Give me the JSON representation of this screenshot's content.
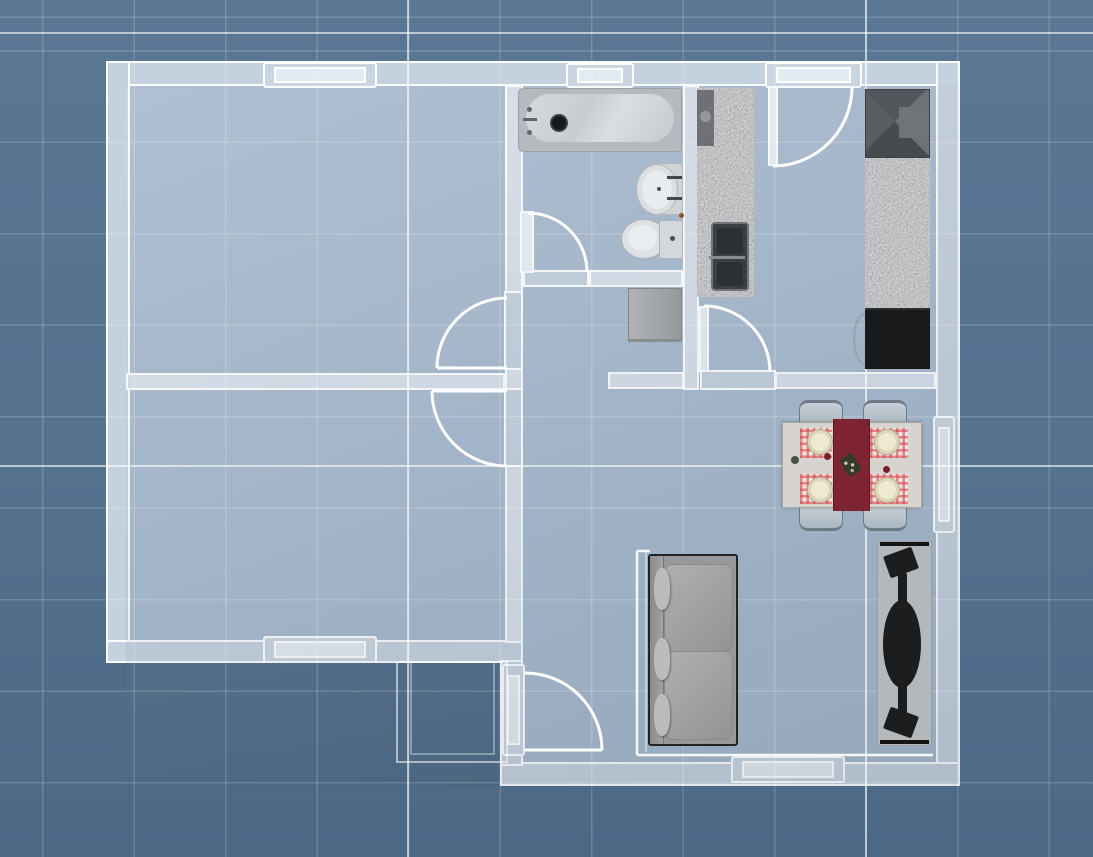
{
  "meta": {
    "view": "2d-floor-plan",
    "style": "blueprint-grid",
    "canvas": {
      "width": 1093,
      "height": 857
    }
  },
  "palette": {
    "background_top": "#5a7794",
    "background_bottom": "#4c6885",
    "grid_minor": "rgba(255,255,255,0.17)",
    "grid_major": "rgba(255,255,255,0.6)",
    "floor": "#a6b9cd",
    "wall_exterior": "#c4d1de",
    "wall_interior": "#d6dfe9",
    "wall_edge": "#ffffff",
    "fixture_light": "#d6dadd",
    "granite": "#898b8e",
    "appliance_dark": "#17191b",
    "runner_red": "#7e2331",
    "placemat_red": "#d8454f",
    "plate_cream": "#efe9d2",
    "chair_gray": "#bcc6cf",
    "sofa_gray": "#98989a",
    "rug_gray": "#b5b8ba"
  },
  "grid": {
    "minor_spacing_px": 91.5,
    "offset_x": 42,
    "offset_y": 50,
    "major_lines": [
      {
        "name": "grid-major-vertical-1",
        "rect": {
          "x": 407,
          "y": 0,
          "w": 2,
          "h": 857
        }
      },
      {
        "name": "grid-major-vertical-2",
        "rect": {
          "x": 865,
          "y": 0,
          "w": 2,
          "h": 857
        }
      },
      {
        "name": "grid-major-horizontal-1",
        "rect": {
          "x": 0,
          "y": 32,
          "w": 1093,
          "h": 2
        }
      },
      {
        "name": "grid-major-horizontal-2",
        "rect": {
          "x": 0,
          "y": 465,
          "w": 1093,
          "h": 2
        }
      }
    ]
  },
  "rooms": [
    {
      "name": "bedroom-1",
      "rect": {
        "x": 126,
        "y": 85,
        "w": 379,
        "h": 288
      }
    },
    {
      "name": "bedroom-2",
      "rect": {
        "x": 126,
        "y": 390,
        "w": 379,
        "h": 253
      }
    },
    {
      "name": "bathroom",
      "rect": {
        "x": 523,
        "y": 85,
        "w": 160,
        "h": 185
      }
    },
    {
      "name": "hallway",
      "rect": {
        "x": 523,
        "y": 270,
        "w": 160,
        "h": 120
      }
    },
    {
      "name": "kitchen",
      "rect": {
        "x": 683,
        "y": 85,
        "w": 253,
        "h": 305
      }
    },
    {
      "name": "living-dining-room",
      "rect": {
        "x": 523,
        "y": 390,
        "w": 413,
        "h": 372
      }
    }
  ],
  "walls": [
    {
      "name": "wall-exterior-top",
      "rect": {
        "x": 106,
        "y": 61,
        "w": 854,
        "h": 25
      }
    },
    {
      "name": "wall-exterior-left",
      "rect": {
        "x": 106,
        "y": 61,
        "w": 24,
        "h": 602
      }
    },
    {
      "name": "wall-bedroom2-south",
      "rect": {
        "x": 106,
        "y": 640,
        "w": 417,
        "h": 23
      }
    },
    {
      "name": "wall-exterior-right",
      "rect": {
        "x": 936,
        "y": 61,
        "w": 24,
        "h": 725
      }
    },
    {
      "name": "wall-living-south",
      "rect": {
        "x": 500,
        "y": 762,
        "w": 460,
        "h": 24
      }
    },
    {
      "name": "wall-living-west",
      "rect": {
        "x": 500,
        "y": 660,
        "w": 23,
        "h": 106
      }
    },
    {
      "name": "wall-center-upper",
      "rect": {
        "x": 505,
        "y": 85,
        "w": 18,
        "h": 208
      }
    },
    {
      "name": "wall-center-lower",
      "rect": {
        "x": 505,
        "y": 465,
        "w": 18,
        "h": 178
      }
    },
    {
      "name": "wall-bedrooms-divider",
      "rect": {
        "x": 126,
        "y": 373,
        "w": 379,
        "h": 17
      }
    },
    {
      "name": "wall-center-junction",
      "rect": {
        "x": 505,
        "y": 368,
        "w": 18,
        "h": 22
      }
    },
    {
      "name": "wall-bathroom-south",
      "rect": {
        "x": 589,
        "y": 270,
        "w": 94,
        "h": 17
      }
    },
    {
      "name": "wall-kitchen-divider",
      "rect": {
        "x": 683,
        "y": 85,
        "w": 16,
        "h": 305
      }
    },
    {
      "name": "wall-hall-south-left",
      "rect": {
        "x": 608,
        "y": 372,
        "w": 76,
        "h": 17
      }
    },
    {
      "name": "wall-hall-south-right",
      "rect": {
        "x": 775,
        "y": 372,
        "w": 161,
        "h": 17
      }
    }
  ],
  "windows": [
    {
      "name": "window-bedroom1-north",
      "orientation": "h",
      "rect": {
        "x": 263,
        "y": 62,
        "w": 114,
        "h": 26
      }
    },
    {
      "name": "window-bathroom-north",
      "orientation": "h",
      "rect": {
        "x": 566,
        "y": 63,
        "w": 68,
        "h": 25
      }
    },
    {
      "name": "window-bedroom2-south",
      "orientation": "h",
      "rect": {
        "x": 263,
        "y": 636,
        "w": 114,
        "h": 27
      }
    },
    {
      "name": "window-living-south",
      "orientation": "h",
      "rect": {
        "x": 731,
        "y": 756,
        "w": 114,
        "h": 27
      }
    },
    {
      "name": "window-dining-east",
      "orientation": "v",
      "rect": {
        "x": 933,
        "y": 416,
        "w": 22,
        "h": 117
      }
    }
  ],
  "doors": [
    {
      "name": "door-bedroom1",
      "frame": {
        "x": 504,
        "y": 291,
        "w": 19,
        "h": 79
      },
      "leaf_line": {
        "x1": 507,
        "y1": 368,
        "x2": 437,
        "y2": 368
      },
      "arc": {
        "x1": 437,
        "y1": 368,
        "x2": 507,
        "y2": 298,
        "r": 70,
        "sweep": 1
      }
    },
    {
      "name": "door-bedroom2",
      "frame": {
        "x": 504,
        "y": 388,
        "w": 19,
        "h": 79
      },
      "leaf_line": {
        "x1": 507,
        "y1": 391,
        "x2": 432,
        "y2": 391
      },
      "arc": {
        "x1": 432,
        "y1": 391,
        "x2": 507,
        "y2": 466,
        "r": 75,
        "sweep": 0
      }
    },
    {
      "name": "door-bathroom",
      "frame": {
        "x": 523,
        "y": 270,
        "w": 66,
        "h": 17
      },
      "leaf_rect": {
        "x": 520,
        "y": 211,
        "w": 14,
        "h": 62
      },
      "arc": {
        "x1": 528,
        "y1": 213,
        "x2": 587,
        "y2": 272,
        "r": 59,
        "sweep": 1
      }
    },
    {
      "name": "door-kitchen-living",
      "frame": {
        "x": 700,
        "y": 370,
        "w": 76,
        "h": 20
      },
      "leaf_rect": {
        "x": 699,
        "y": 306,
        "w": 10,
        "h": 66
      },
      "arc": {
        "x1": 704,
        "y1": 306,
        "x2": 770,
        "y2": 372,
        "r": 66,
        "sweep": 1
      }
    },
    {
      "name": "door-kitchen-north",
      "frame": {
        "x": 765,
        "y": 62,
        "w": 97,
        "h": 26
      },
      "leaf_rect": {
        "x": 768,
        "y": 86,
        "w": 10,
        "h": 80
      },
      "arc": {
        "x1": 773,
        "y1": 166,
        "x2": 852,
        "y2": 87,
        "r": 79,
        "sweep": 0
      }
    },
    {
      "name": "door-entry",
      "frame": {
        "x": 502,
        "y": 664,
        "w": 23,
        "h": 92
      },
      "leaf_line": {
        "x1": 525,
        "y1": 750,
        "x2": 602,
        "y2": 750
      },
      "arc": {
        "x1": 525,
        "y1": 673,
        "x2": 602,
        "y2": 750,
        "r": 77,
        "sweep": 1
      }
    }
  ],
  "furniture": {
    "bathtub": {
      "rect": {
        "x": 518,
        "y": 88,
        "w": 164,
        "h": 64
      }
    },
    "washbasin": {
      "rect": {
        "x": 636,
        "y": 161,
        "w": 47,
        "h": 55
      }
    },
    "toilet": {
      "rect": {
        "x": 621,
        "y": 219,
        "w": 62,
        "h": 40
      }
    },
    "washer": {
      "rect": {
        "x": 628,
        "y": 288,
        "w": 54,
        "h": 54
      }
    },
    "counter_left": {
      "rect": {
        "x": 697,
        "y": 88,
        "w": 57,
        "h": 209
      }
    },
    "counter_hood": {
      "rect": {
        "x": 697,
        "y": 90,
        "w": 17,
        "h": 56
      }
    },
    "kitchen_sink": {
      "rect": {
        "x": 711,
        "y": 222,
        "w": 38,
        "h": 69
      }
    },
    "fridge": {
      "rect": {
        "x": 865,
        "y": 89,
        "w": 65,
        "h": 69
      }
    },
    "counter_right": {
      "rect": {
        "x": 865,
        "y": 158,
        "w": 65,
        "h": 150
      }
    },
    "stool": {
      "rect": {
        "x": 853,
        "y": 313,
        "w": 24,
        "h": 52
      }
    },
    "cooktop": {
      "rect": {
        "x": 865,
        "y": 308,
        "w": 65,
        "h": 61
      }
    },
    "chairs": [
      {
        "side": "top",
        "rect": {
          "x": 799,
          "y": 400,
          "w": 44,
          "h": 26
        }
      },
      {
        "side": "top",
        "rect": {
          "x": 863,
          "y": 400,
          "w": 44,
          "h": 26
        }
      },
      {
        "side": "bottom",
        "rect": {
          "x": 799,
          "y": 505,
          "w": 44,
          "h": 26
        }
      },
      {
        "side": "bottom",
        "rect": {
          "x": 863,
          "y": 505,
          "w": 44,
          "h": 26
        }
      }
    ],
    "dining_table": {
      "rect": {
        "x": 782,
        "y": 422,
        "w": 140,
        "h": 86
      }
    },
    "runner": {
      "rect": {
        "x": 833,
        "y": 419,
        "w": 37,
        "h": 92
      }
    },
    "placemats": [
      {
        "rect": {
          "x": 800,
          "y": 428,
          "w": 32,
          "h": 30
        }
      },
      {
        "rect": {
          "x": 870,
          "y": 428,
          "w": 38,
          "h": 30
        }
      },
      {
        "rect": {
          "x": 800,
          "y": 474,
          "w": 32,
          "h": 30
        }
      },
      {
        "rect": {
          "x": 870,
          "y": 474,
          "w": 38,
          "h": 30
        }
      }
    ],
    "plates": [
      {
        "rect": {
          "x": 807,
          "y": 429,
          "w": 26,
          "h": 26
        }
      },
      {
        "rect": {
          "x": 874,
          "y": 429,
          "w": 26,
          "h": 26
        }
      },
      {
        "rect": {
          "x": 807,
          "y": 477,
          "w": 26,
          "h": 26
        }
      },
      {
        "rect": {
          "x": 874,
          "y": 477,
          "w": 26,
          "h": 26
        }
      }
    ],
    "table_items": {
      "green_cup": {
        "rect": {
          "x": 791,
          "y": 456,
          "w": 8,
          "h": 8
        }
      },
      "red_cup_1": {
        "rect": {
          "x": 824,
          "y": 453,
          "w": 7,
          "h": 7
        }
      },
      "red_cup_2": {
        "rect": {
          "x": 883,
          "y": 466,
          "w": 7,
          "h": 7
        }
      },
      "basket": {
        "rect": {
          "x": 843,
          "y": 455,
          "w": 15,
          "h": 20,
          "rot": -32
        }
      }
    },
    "sofa": {
      "rect": {
        "x": 648,
        "y": 554,
        "w": 90,
        "h": 192
      }
    },
    "rug": {
      "rect": {
        "x": 877,
        "y": 541,
        "w": 55,
        "h": 205
      }
    },
    "hammock": {
      "bar_top": {
        "rect": {
          "x": 880,
          "y": 542,
          "w": 49,
          "h": 4
        }
      },
      "bar_bottom": {
        "rect": {
          "x": 880,
          "y": 740,
          "w": 49,
          "h": 4
        }
      },
      "pad": {
        "rect": {
          "x": 883,
          "y": 600,
          "w": 38,
          "h": 88
        }
      },
      "stem_top": {
        "rect": {
          "x": 898,
          "y": 573,
          "w": 9,
          "h": 33
        }
      },
      "stem_bottom": {
        "rect": {
          "x": 898,
          "y": 682,
          "w": 9,
          "h": 33
        }
      },
      "foot_top": {
        "rect": {
          "x": 886,
          "y": 551,
          "w": 30,
          "h": 23,
          "rot": -20
        }
      },
      "foot_bottom": {
        "rect": {
          "x": 886,
          "y": 711,
          "w": 30,
          "h": 23,
          "rot": 20
        }
      }
    }
  },
  "annotations": {
    "lines": [
      {
        "name": "room-edge-vertical",
        "x1": 637,
        "y1": 551,
        "x2": 637,
        "y2": 755,
        "w": 2.5,
        "o": 0.9
      },
      {
        "name": "room-edge-vertical-2",
        "x1": 646,
        "y1": 552,
        "x2": 646,
        "y2": 752,
        "w": 1.5,
        "o": 0.5
      },
      {
        "name": "room-edge-top-tick",
        "x1": 637,
        "y1": 551,
        "x2": 650,
        "y2": 551,
        "w": 2.5,
        "o": 0.9
      },
      {
        "name": "room-edge-horizontal",
        "x1": 637,
        "y1": 755,
        "x2": 933,
        "y2": 755,
        "w": 2.5,
        "o": 0.9
      }
    ],
    "rects": [
      {
        "name": "terrace-outline-outer",
        "x": 397,
        "y": 662,
        "w": 110,
        "h": 100,
        "o": 0.55
      },
      {
        "name": "terrace-outline-inner",
        "x": 411,
        "y": 662,
        "w": 83,
        "h": 92,
        "o": 0.35
      }
    ]
  }
}
